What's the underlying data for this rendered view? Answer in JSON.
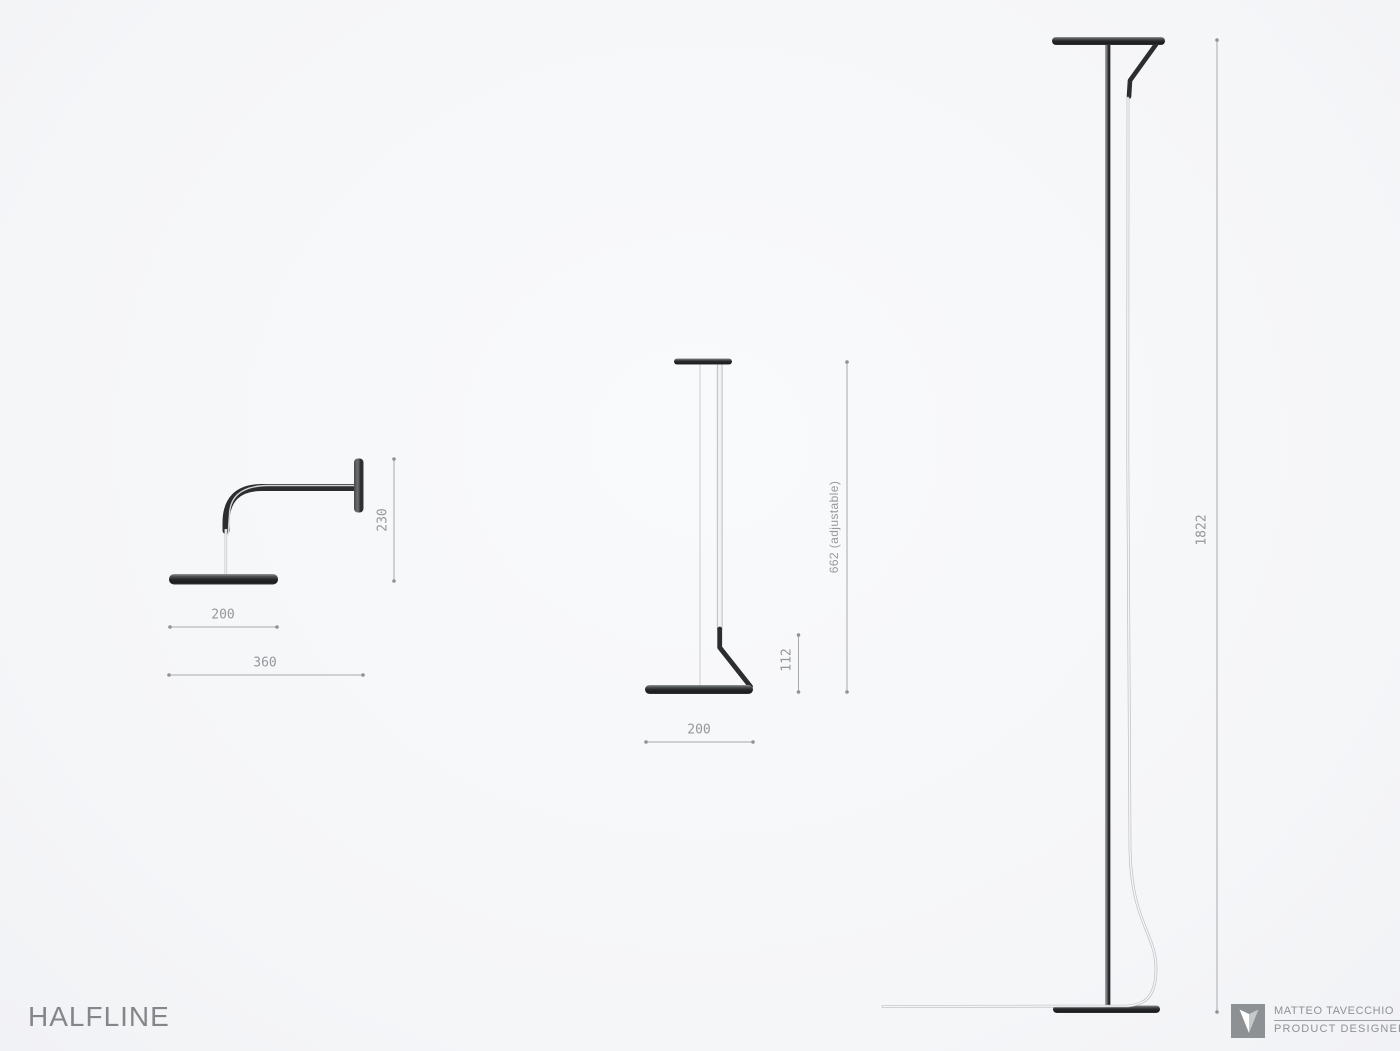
{
  "title": "HALFLINE",
  "lamps": {
    "wall": {
      "dim_height": "230",
      "dim_shade_width": "200",
      "dim_total_width": "360"
    },
    "pendant": {
      "dim_drop": "662 (adjustable)",
      "dim_elbow_height": "112",
      "dim_shade_width": "200"
    },
    "floor": {
      "dim_height": "1822"
    }
  },
  "credit": {
    "name": "MATTEO TAVECCHIO",
    "role": "PRODUCT DESIGNER"
  },
  "colors": {
    "background": "#f6f7f9",
    "ink": "#2b2d2f",
    "dimension_line": "#a6aaae",
    "dimension_text": "#93979b",
    "logo_gray": "#8e9194"
  }
}
